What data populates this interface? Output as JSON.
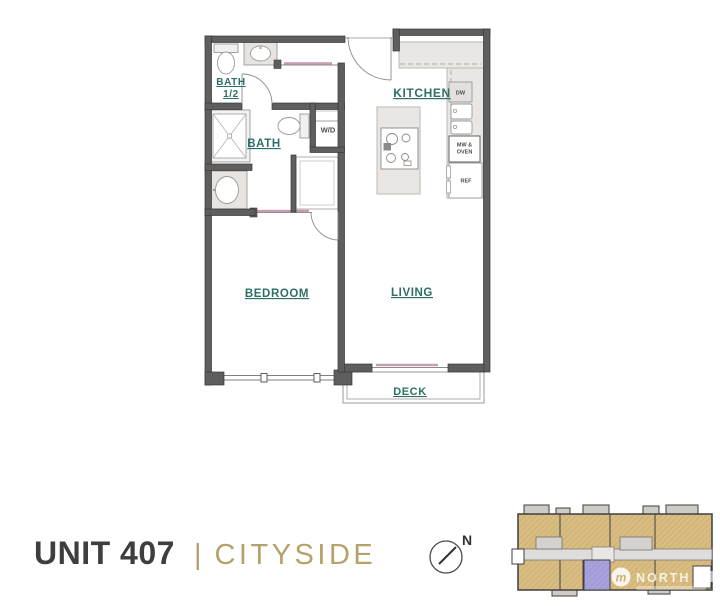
{
  "title": {
    "unit": "UNIT 407",
    "divider": "|",
    "name": "CITYSIDE"
  },
  "floorplan": {
    "labels": {
      "bath_half_line1": "BATH",
      "bath_half_line2": "1/2",
      "bath": "BATH",
      "wd": "W/D",
      "kitchen": "KITCHEN",
      "bedroom": "BEDROOM",
      "living": "LIVING",
      "deck": "DECK",
      "dw": "DW",
      "mw_oven_line1": "MW &",
      "mw_oven_line2": "OVEN",
      "ref": "REF"
    },
    "colors": {
      "label_teal": "#2E6F66",
      "wall_gray": "#5E5E5E",
      "door_mauve": "#C79CB2"
    }
  },
  "compass": {
    "north_label": "N"
  },
  "siteplan": {
    "watermark_line1": "NORTH",
    "watermark_logo_letter": "m",
    "colors": {
      "unit_tan": "#D8BC82",
      "highlight_purple": "#A8A2DC",
      "corridor_gray": "#DEDDDB"
    }
  }
}
